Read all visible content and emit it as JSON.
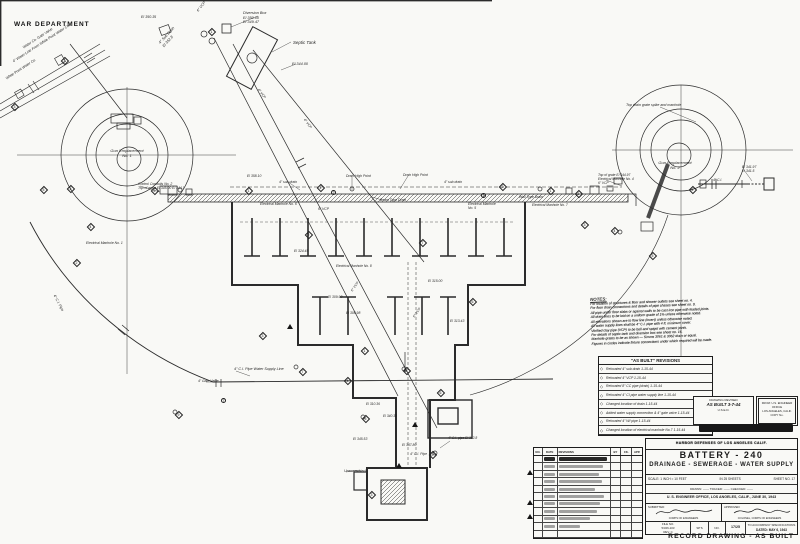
{
  "header": {
    "department": "WAR DEPARTMENT"
  },
  "notes": {
    "title": "NOTES:",
    "lines": [
      "For location of structures & floor and shower outlets see sheet no. 4.",
      "For floor drain connections and details of pipe chases see sheet no. 9.",
      "All pipe under floor slabs or against walls to be cast iron pipe with leaded joints.",
      "All drain lines to be laid on a uniform grade of 1% unless otherwise noted.",
      "All elevations shown are to flow line (invert) unless otherwise noted.",
      "All water supply lines shall be 4\" C.I. pipe with 4 ft. minimum cover.",
      "Vitrified clay pipe (VCP) to be bell and spigot with cement joints.",
      "For details of septic tank and diversion box see sheet no. 16.",
      "Manhole grates to be as shown — Simms 3061 & 3062 drain or equal.",
      "Figures in circles indicate fixture connections under which required will be made."
    ]
  },
  "as_built": {
    "title": "\"AS BUILT\" REVISIONS",
    "items": [
      "Relocated 4\" sub drain   1-15-44",
      "Relocated 4\" VCP   1-15-44",
      "Relocated 8\" CC pipe (drain)   1-15-44",
      "Relocated 4\" CI pipe water supply line  1-15-44",
      "Changed location of drain   1-15-44",
      "Added water supply connection & 4\" gate valve  1-15-44",
      "Relocated 4\" WI pipe   1-15-44",
      "Changed location of electrical manhole No.7  1-15-44"
    ]
  },
  "stamps": {
    "revised": {
      "line1": "DRAWING REVISED",
      "line2": "AS BUILT  3-7-44",
      "line3": "U.S.E.D."
    },
    "office": {
      "line1": "FROM: U.S. ENGINEER OFFICE",
      "line2": "LOS ANGELES, CALIF.",
      "line3": "COPY No."
    }
  },
  "rev_table": {
    "headers": [
      "NO.",
      "DATE",
      "REVISIONS",
      "BY",
      "CK.",
      "APP."
    ],
    "smudge_widths": [
      95,
      88,
      80,
      85,
      72,
      90,
      82,
      76,
      62,
      42,
      0
    ]
  },
  "title_block": {
    "org": "HARBOR DEFENSES OF LOS ANGELES CALIF.",
    "battery": "BATTERY - 240",
    "subtitle": "DRAINAGE - SEWERAGE - WATER SUPPLY",
    "scale_left": "SCALE: 1 INCH = 10 FEET",
    "scale_mid": "IN 25 SHEETS",
    "scale_right": "SHEET NO. 17",
    "drawn_line": "DRAWN: ——   TRACED: ——   CHECKED: ——",
    "office_line": "U. S. ENGINEER OFFICE, LOS ANGELES, CALIF., JUNE 30, 1943",
    "submitted_label": "SUBMITTED:",
    "approved_label": "APPROVED:",
    "submitted_caption": "CORPS OF ENGINEERS",
    "approved_caption": "COLONEL, CORPS OF ENGINEERS",
    "file_label": "FILE NO.",
    "file_no": "5/326-103",
    "rev": "REV. C",
    "sps": "SP'S",
    "no_label": "NO.",
    "sheet_frac": "17/25",
    "spec1": "TO ACCOMPANY SPECIFICATIONS",
    "spec2": "DATED: MAY 6, 1943",
    "record": "RECORD DRAWING - AS BUILT"
  },
  "plan": {
    "labels": [
      {
        "x": 243,
        "y": 11,
        "t": "Diversion Box\nEl 350.00\nEl 349.47",
        "fs": 3.8
      },
      {
        "x": 293,
        "y": 40,
        "t": "Septic Tank",
        "fs": 4.4
      },
      {
        "x": 292,
        "y": 62,
        "t": "El 344.00",
        "fs": 3.8
      },
      {
        "x": 158,
        "y": 42,
        "t": "4\" Sub Drain\nEl 352.8",
        "r": -48,
        "fs": 3.8
      },
      {
        "x": 141,
        "y": 15,
        "t": "El 350.35",
        "fs": 3.6
      },
      {
        "x": 196,
        "y": 10,
        "t": "6\" VCP",
        "r": -52,
        "fs": 3.6
      },
      {
        "x": 22,
        "y": 46,
        "t": "Water Co. Gate Valve",
        "r": -33,
        "fs": 3.6
      },
      {
        "x": 12,
        "y": 60,
        "t": "4\" Water Line From White Point Water Co.",
        "r": -33,
        "fs": 3.6
      },
      {
        "x": 5,
        "y": 77,
        "t": "White Point Water Co.",
        "r": -33,
        "fs": 3.6
      },
      {
        "x": 98,
        "y": 149,
        "t": "Gun Emplacement\nNo. 1",
        "fs": 4,
        "w": 58,
        "c": 1
      },
      {
        "x": 138,
        "y": 182,
        "t": "Control Conduits No. 2\nTop of grate El 345.00  El 344.1",
        "fs": 3.4,
        "w": 72
      },
      {
        "x": 86,
        "y": 241,
        "t": "Electrical Manhole No. 1",
        "fs": 3.4
      },
      {
        "x": 247,
        "y": 174,
        "t": "El 358.10",
        "fs": 3.4
      },
      {
        "x": 279,
        "y": 180,
        "t": "4\" sub drain",
        "fs": 3.4
      },
      {
        "x": 346,
        "y": 174,
        "t": "Drain High Point",
        "fs": 3.4
      },
      {
        "x": 403,
        "y": 173,
        "t": "Drain High Point",
        "fs": 3.4
      },
      {
        "x": 444,
        "y": 180,
        "t": "4\" sub drain",
        "fs": 3.4
      },
      {
        "x": 260,
        "y": 202,
        "t": "Electrical Manhole No. 6",
        "fs": 3.4
      },
      {
        "x": 318,
        "y": 207,
        "t": "6\" VCP",
        "fs": 3.4
      },
      {
        "x": 380,
        "y": 198,
        "t": "Beam Type Drain",
        "fs": 3.4
      },
      {
        "x": 468,
        "y": 202,
        "t": "Electrical Manhole\nNo. 5",
        "fs": 3.4,
        "w": 40
      },
      {
        "x": 519,
        "y": 195,
        "t": "Wall Type Drain",
        "fs": 3.4
      },
      {
        "x": 532,
        "y": 204,
        "t": "Electrical Manhole No. 7",
        "fs": 3.3
      },
      {
        "x": 626,
        "y": 103,
        "t": "Top drain grate spike and manhole",
        "fs": 3.6,
        "w": 95
      },
      {
        "x": 646,
        "y": 161,
        "t": "Gun Emplacement\nNo. 2",
        "fs": 4,
        "w": 58,
        "c": 1
      },
      {
        "x": 598,
        "y": 174,
        "t": "Top of grate El 344.97\nElectrical Manhole No. 4\n6\" VCP",
        "fs": 3.3,
        "w": 58
      },
      {
        "x": 742,
        "y": 165,
        "t": "El 341.97\nEl 341.5",
        "fs": 3.4
      },
      {
        "x": 713,
        "y": 178,
        "t": "4\" C.I.",
        "fs": 3.4
      },
      {
        "x": 294,
        "y": 249,
        "t": "El 324.45",
        "fs": 3.4
      },
      {
        "x": 336,
        "y": 265,
        "t": "Electrical Manhole No. 8",
        "fs": 3.3
      },
      {
        "x": 328,
        "y": 295,
        "t": "El 309.98",
        "fs": 3.4
      },
      {
        "x": 346,
        "y": 311,
        "t": "El 308.98",
        "fs": 3.4
      },
      {
        "x": 428,
        "y": 279,
        "t": "El 315.00",
        "fs": 3.4
      },
      {
        "x": 450,
        "y": 319,
        "t": "El 313.43",
        "fs": 3.4
      },
      {
        "x": 350,
        "y": 290,
        "t": "6\" VCP",
        "r": -55,
        "fs": 3.4
      },
      {
        "x": 412,
        "y": 316,
        "t": "6\" VCP",
        "r": -55,
        "fs": 3.4
      },
      {
        "x": 306,
        "y": 118,
        "t": "6\" VCP",
        "r": 53,
        "fs": 3.4
      },
      {
        "x": 260,
        "y": 88,
        "t": "6\" VCP",
        "r": 53,
        "fs": 3.4
      },
      {
        "x": 234,
        "y": 367,
        "t": "4\" C.I. Pipe Water Supply Line",
        "fs": 3.7
      },
      {
        "x": 198,
        "y": 379,
        "t": "4\" Gate Valve",
        "fs": 3.4
      },
      {
        "x": 56,
        "y": 294,
        "t": "4\" C.I. Pipe",
        "r": 62,
        "fs": 3.6
      },
      {
        "x": 353,
        "y": 437,
        "t": "El 345.53",
        "fs": 3.4
      },
      {
        "x": 402,
        "y": 443,
        "t": "El 347.80",
        "fs": 3.4
      },
      {
        "x": 410,
        "y": 452,
        "t": "4\" C.I. Pipe",
        "fs": 3.4
      },
      {
        "x": 344,
        "y": 469,
        "t": "Unexcavated",
        "fs": 3.7
      },
      {
        "x": 448,
        "y": 437,
        "t": "4\" C.I. pipe  El 312.8",
        "fs": 3.3
      },
      {
        "x": 383,
        "y": 415,
        "t": "El 340.32",
        "fs": 3.3
      },
      {
        "x": 366,
        "y": 403,
        "t": "El 310.36",
        "fs": 3.3
      }
    ],
    "diamonds": [
      {
        "x": 40,
        "y": 186,
        "n": "5"
      },
      {
        "x": 67,
        "y": 185,
        "n": "3"
      },
      {
        "x": 87,
        "y": 223,
        "n": "4"
      },
      {
        "x": 73,
        "y": 259,
        "n": "2"
      },
      {
        "x": 151,
        "y": 187,
        "n": "6"
      },
      {
        "x": 245,
        "y": 187,
        "n": "1"
      },
      {
        "x": 305,
        "y": 231,
        "n": "2"
      },
      {
        "x": 259,
        "y": 332,
        "n": "3"
      },
      {
        "x": 299,
        "y": 368,
        "n": "7"
      },
      {
        "x": 403,
        "y": 367,
        "n": "8"
      },
      {
        "x": 362,
        "y": 415,
        "n": "5"
      },
      {
        "x": 344,
        "y": 377,
        "n": "4"
      },
      {
        "x": 175,
        "y": 411,
        "n": "9"
      },
      {
        "x": 469,
        "y": 298,
        "n": "6"
      },
      {
        "x": 499,
        "y": 183,
        "n": "2"
      },
      {
        "x": 547,
        "y": 187,
        "n": "1"
      },
      {
        "x": 581,
        "y": 221,
        "n": "3"
      },
      {
        "x": 611,
        "y": 227,
        "n": "4"
      },
      {
        "x": 649,
        "y": 252,
        "n": "5"
      },
      {
        "x": 689,
        "y": 186,
        "n": "2"
      },
      {
        "x": 419,
        "y": 239,
        "n": "7"
      },
      {
        "x": 317,
        "y": 184,
        "n": "4"
      },
      {
        "x": 361,
        "y": 347,
        "n": "1"
      },
      {
        "x": 437,
        "y": 389,
        "n": "6"
      },
      {
        "x": 61,
        "y": 57,
        "n": "2"
      },
      {
        "x": 11,
        "y": 103,
        "n": "3"
      },
      {
        "x": 208,
        "y": 28,
        "n": "1"
      },
      {
        "x": 429,
        "y": 451,
        "n": "8"
      },
      {
        "x": 368,
        "y": 491,
        "n": "3"
      },
      {
        "x": 575,
        "y": 190,
        "n": "1"
      }
    ],
    "circles": [
      {
        "x": 480,
        "y": 192,
        "n": "3"
      },
      {
        "x": 330,
        "y": 189,
        "n": "2"
      },
      {
        "x": 220,
        "y": 397,
        "n": "7"
      }
    ],
    "triangles": [
      {
        "x": 287,
        "y": 324
      },
      {
        "x": 396,
        "y": 463
      },
      {
        "x": 412,
        "y": 422
      }
    ]
  }
}
